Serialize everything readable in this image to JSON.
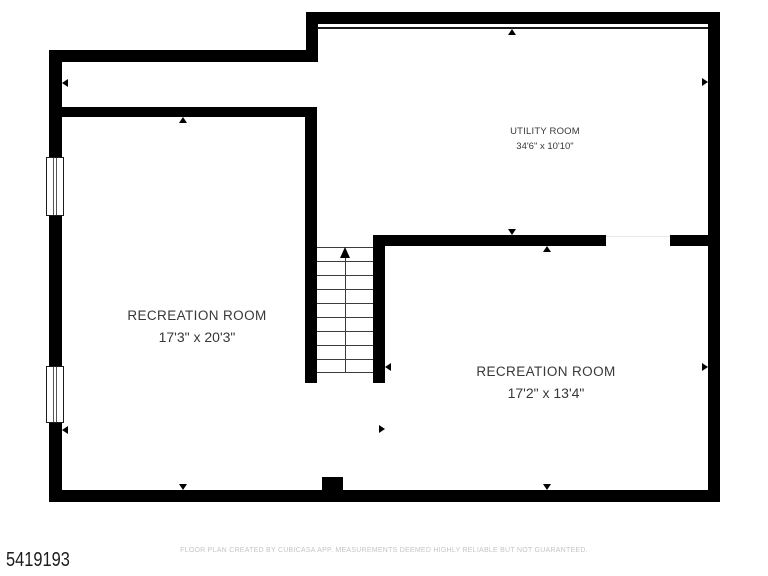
{
  "plan": {
    "listing_id": "5419193",
    "footer_text": "FLOOR PLAN CREATED BY CUBICASA APP. MEASUREMENTS DEEMED HIGHLY RELIABLE BUT NOT GUARANTEED.",
    "rooms": {
      "utility": {
        "name": "UTILITY ROOM",
        "dimensions": "34'6\" x 10'10\""
      },
      "recreation_left": {
        "name": "RECREATION ROOM",
        "dimensions": "17'3\" x 20'3\""
      },
      "recreation_right": {
        "name": "RECREATION ROOM",
        "dimensions": "17'2\" x 13'4\""
      }
    },
    "icons": {
      "stairs_up_arrow": "triangle-up",
      "measure_tick": "small-triangle-toward-wall"
    },
    "colors": {
      "wall": "#000000",
      "background": "#ffffff",
      "label_text": "#383838",
      "watermark_text": "#c5c5c5"
    }
  }
}
